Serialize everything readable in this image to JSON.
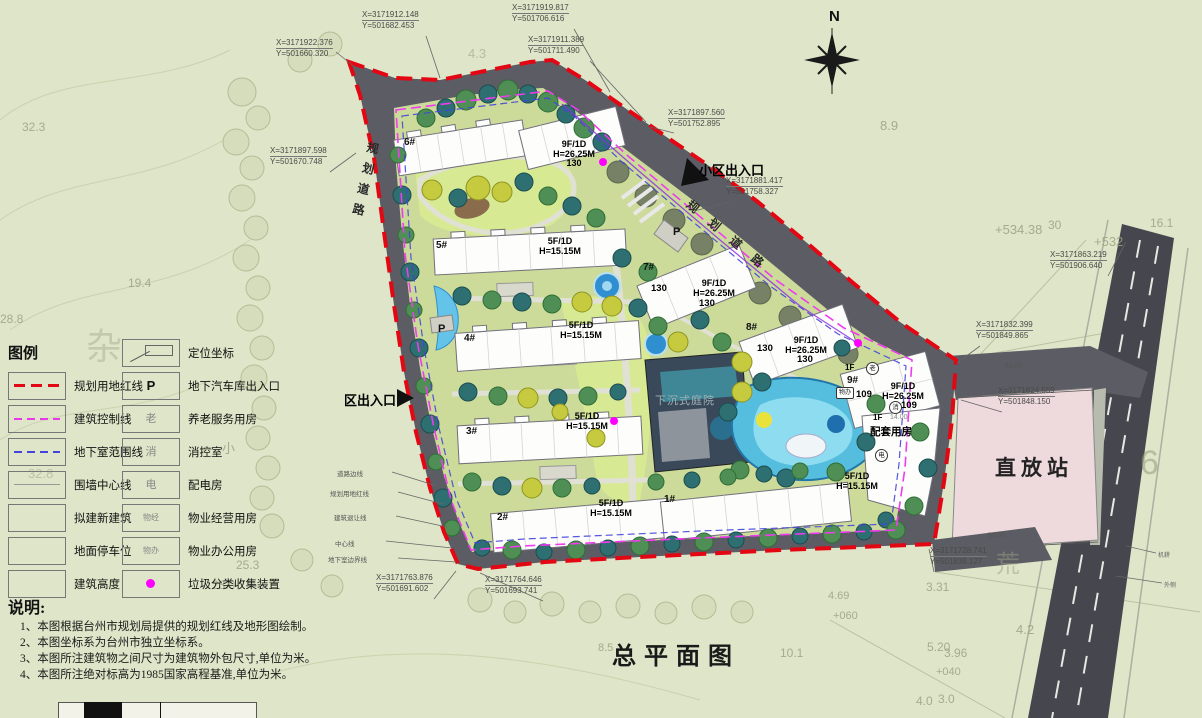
{
  "title": "总平面图",
  "north": "N",
  "legend": {
    "title": "图例",
    "left": [
      {
        "label": "规划用地红线",
        "swatch": "red-dash"
      },
      {
        "label": "建筑控制线",
        "swatch": "magenta-dash"
      },
      {
        "label": "地下室范围线",
        "swatch": "blue-dash"
      },
      {
        "label": "围墙中心线",
        "swatch": "thin-line"
      },
      {
        "label": "拟建新建筑",
        "swatch": "empty-box"
      },
      {
        "label": "地面停车位",
        "swatch": "empty-box"
      },
      {
        "label": "建筑高度",
        "swatch": "empty-box"
      }
    ],
    "right": [
      {
        "symbol": "",
        "icon": "coordinate-flag",
        "label": "定位坐标"
      },
      {
        "symbol": "P",
        "icon": "text",
        "label": "地下汽车库出入口"
      },
      {
        "symbol": "老",
        "icon": "text",
        "label": "养老服务用房"
      },
      {
        "symbol": "消",
        "icon": "text",
        "label": "消控室"
      },
      {
        "symbol": "电",
        "icon": "text",
        "label": "配电房"
      },
      {
        "symbol": "物经",
        "icon": "text",
        "label": "物业经营用房"
      },
      {
        "symbol": "物办",
        "icon": "text",
        "label": "物业办公用房"
      },
      {
        "symbol": "",
        "icon": "magenta-dot",
        "label": "垃圾分类收集装置"
      }
    ]
  },
  "notes": {
    "title": "说明:",
    "items": [
      "1、本图根据台州市规划局提供的规划红线及地形图绘制。",
      "2、本图坐标系为台州市独立坐标系。",
      "3、本图所注建筑物之间尺寸为建筑物外包尺寸,单位为米。",
      "4、本图所注绝对标高为1985国家高程基准,单位为米。"
    ]
  },
  "coords": [
    {
      "x": "X=3171922.376",
      "y": "Y=501660.320"
    },
    {
      "x": "X=3171912.148",
      "y": "Y=501682.453"
    },
    {
      "x": "X=3171919.817",
      "y": "Y=501706.616"
    },
    {
      "x": "X=3171911.389",
      "y": "Y=501711.490"
    },
    {
      "x": "X=3171897.560",
      "y": "Y=501752.895"
    },
    {
      "x": "X=3171881.417",
      "y": "Y=501758.327"
    },
    {
      "x": "X=3171897.598",
      "y": "Y=501670.748"
    },
    {
      "x": "X=3171863.219",
      "y": "Y=501906.640"
    },
    {
      "x": "X=3171832.399",
      "y": "Y=501849.865"
    },
    {
      "x": "X=3171824.559",
      "y": "Y=501848.150"
    },
    {
      "x": "X=3171728.741",
      "y": "Y=501838.127"
    },
    {
      "x": "X=3171763.876",
      "y": "Y=501691.602"
    },
    {
      "x": "X=3171764.646",
      "y": "Y=501693.741"
    }
  ],
  "buildings": {
    "b1": "1#",
    "b2": "2#",
    "b3": "3#",
    "b4": "4#",
    "b5": "5#",
    "b6": "6#",
    "b7": "7#",
    "b8": "8#",
    "b9": "9#"
  },
  "specs": {
    "low_f": "5F/1D",
    "low_h": "H=15.15M",
    "high_f": "9F/1D",
    "high_h": "H=26.25M",
    "d130": "130",
    "d109": "109"
  },
  "b9_annex": {
    "fl": "1F",
    "elev": "14.00",
    "name": "配套用房",
    "badge_elder": "老",
    "badge_office": "物办",
    "badge_fire": "消",
    "badge_power": "电"
  },
  "map_labels": {
    "entrance_main": "小区出入口",
    "entrance_side": "区出入口",
    "road": "规划道路",
    "sunken_courtyard": "下沉式庭院",
    "repeater_station": "直放站",
    "parking": "P"
  },
  "dims": {
    "d50": "50.00"
  },
  "boundary_notes": [
    "道路边线",
    "规划用地红线",
    "建筑退让线",
    "中心线",
    "地下室边界线"
  ],
  "edge_notes": [
    "机耕",
    "外侧"
  ],
  "terrain": [
    "32.3",
    "19.4",
    "28.8",
    "杂",
    "11.0",
    "小",
    "32.8",
    "25.3",
    "23.0",
    "4.3",
    "8.9",
    "30",
    "16.1",
    "+534.38",
    "+532",
    "6",
    "荒",
    "3.31",
    "4.69",
    "+060",
    "4.2",
    "5.20",
    "10.1",
    "3.96",
    "+040",
    "4.0",
    "3.0",
    "8.5"
  ],
  "colors": {
    "boundary_red": "#e30613",
    "control_magenta": "#e838e8",
    "basement_blue": "#4444dd",
    "road_gray": "#5c5c64",
    "station_pink": "#eed9dd",
    "site_green": "#ccdb9a",
    "trash_dot": "#ff00ff"
  }
}
